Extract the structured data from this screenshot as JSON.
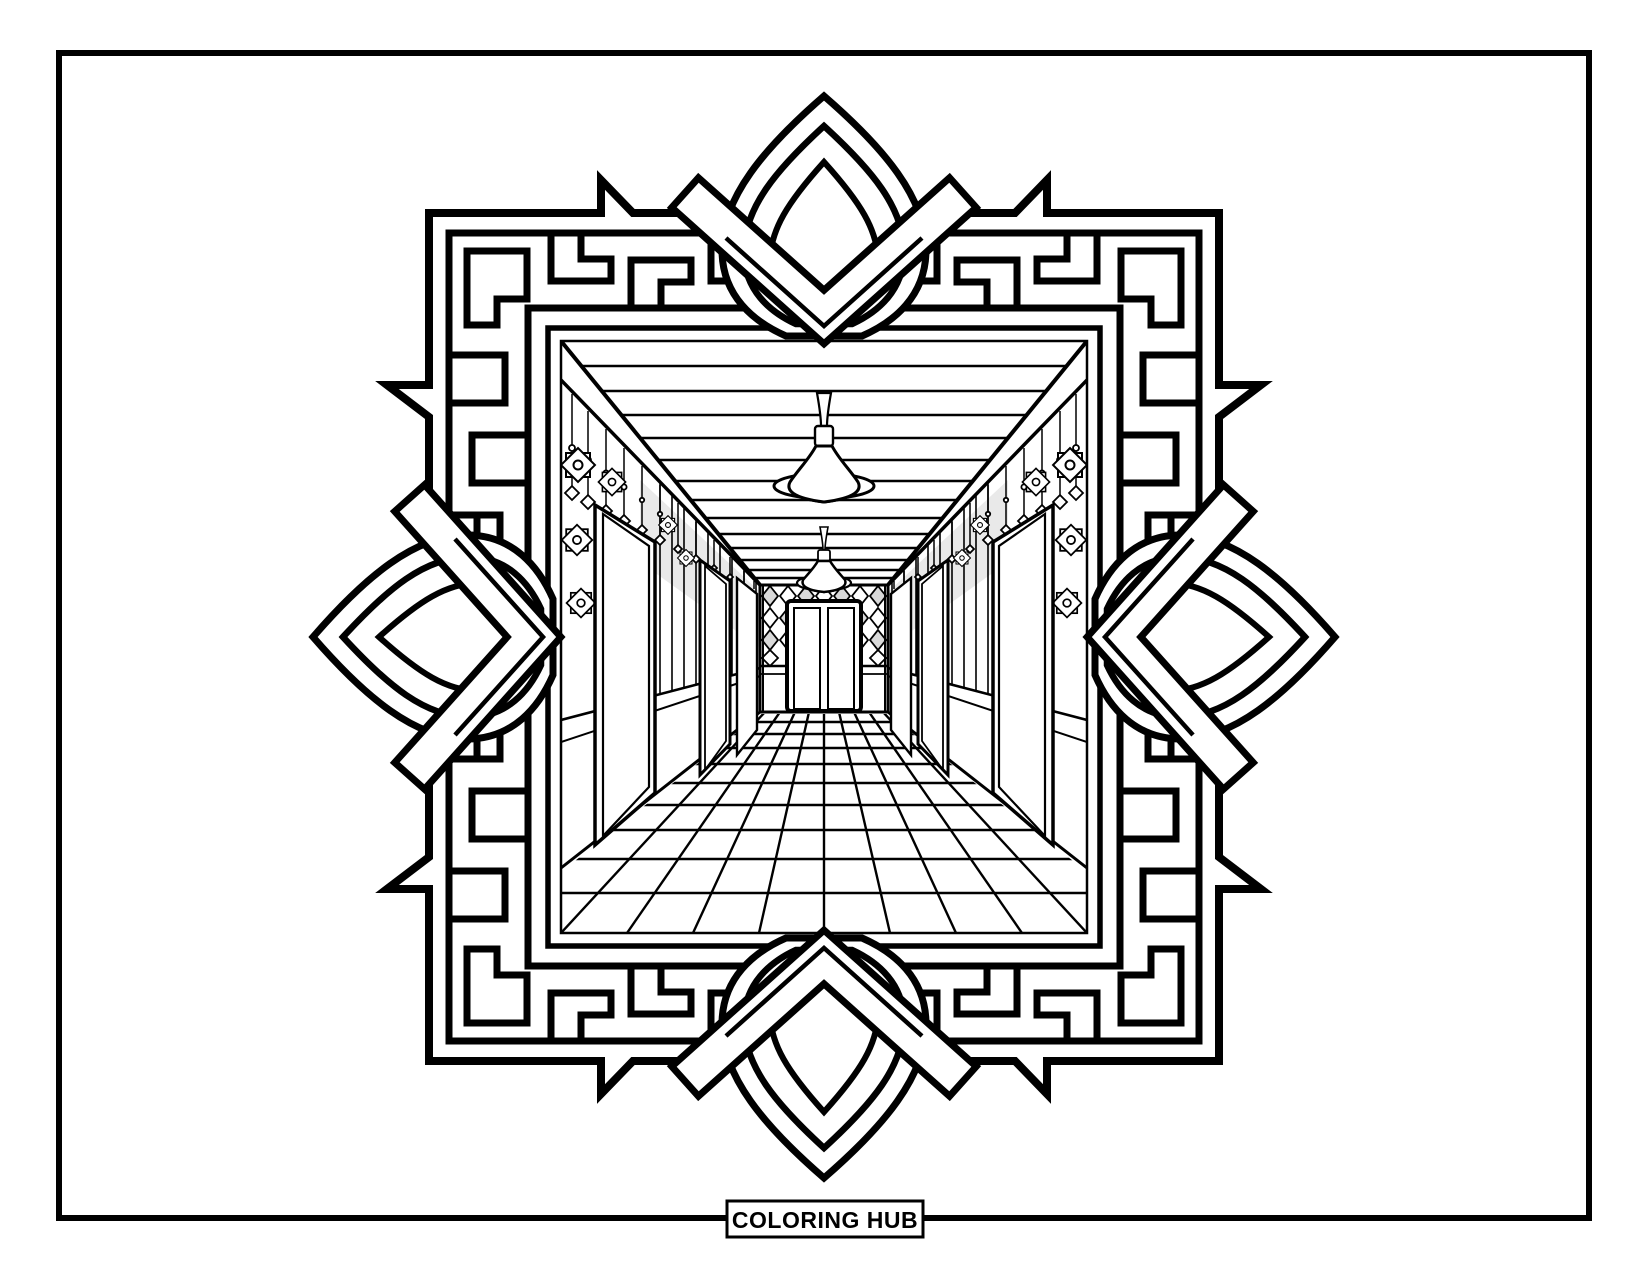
{
  "page": {
    "brand_label": "COLORING HUB",
    "type_label": "coloring page",
    "subject": "one-point perspective hallway inside ornamental maze frame"
  },
  "colors": {
    "line": "#000000",
    "background": "#ffffff",
    "shade": "#d9d9d9",
    "shade_light": "#e9e9e9"
  }
}
